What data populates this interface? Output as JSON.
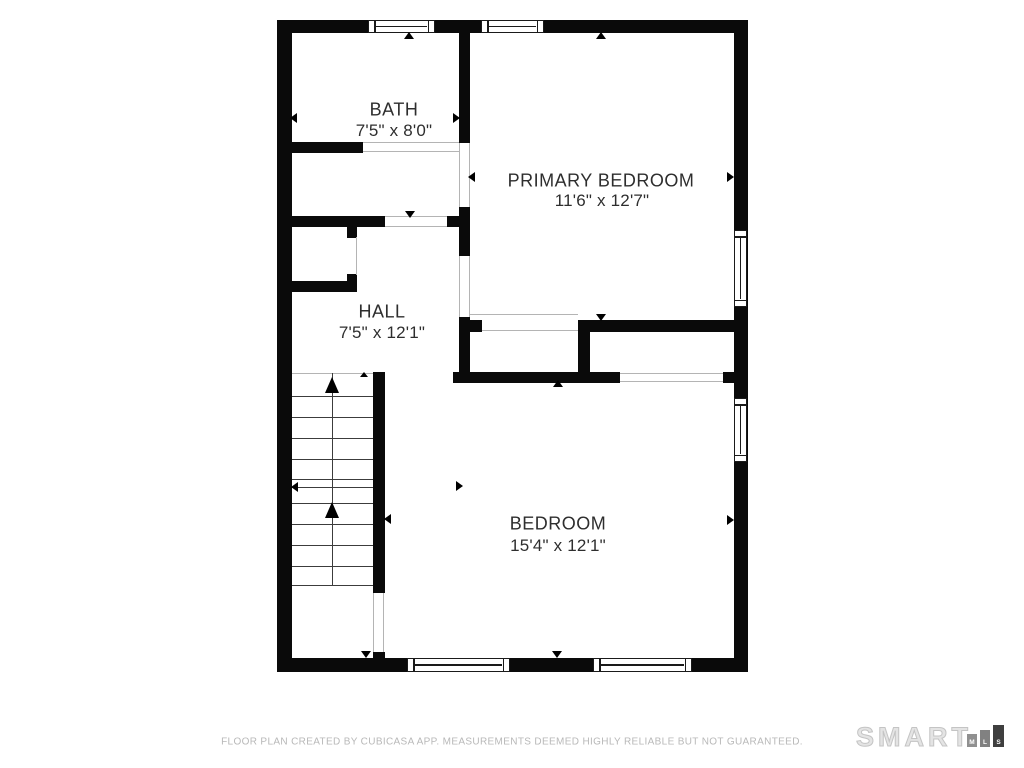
{
  "floor_plan": {
    "rooms": [
      {
        "name": "BATH",
        "dims": "7'5\" x 8'0\""
      },
      {
        "name": "PRIMARY BEDROOM",
        "dims": "11'6\" x 12'7\""
      },
      {
        "name": "HALL",
        "dims": "7'5\" x 12'1\""
      },
      {
        "name": "BEDROOM",
        "dims": "15'4\" x 12'1\""
      }
    ]
  },
  "footer": {
    "disclaimer": "FLOOR PLAN CREATED BY CUBICASA APP. MEASUREMENTS DEEMED HIGHLY RELIABLE BUT NOT GUARANTEED."
  },
  "branding": {
    "name": "SMART",
    "mls_letters": [
      "M",
      "L",
      "S"
    ]
  },
  "colors": {
    "wall": "#0a0a0a",
    "label_text": "#2e2e2e",
    "footer_text": "#b8b8b8",
    "logo_outline": "#c4c4c4",
    "mls_block_m": "#909090",
    "mls_block_l": "#818181",
    "mls_block_s": "#3f3f3f"
  }
}
